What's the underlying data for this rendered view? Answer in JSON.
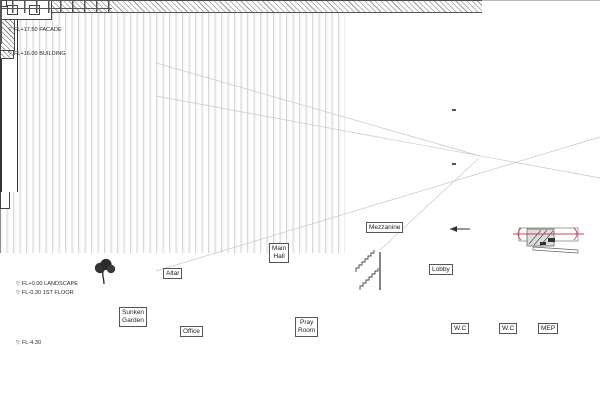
{
  "drawing": {
    "type": "architectural-section",
    "levels": [
      {
        "marker": "▽",
        "label": "FL+17.50 FACADE"
      },
      {
        "marker": "▽",
        "label": "FL+16.00 BUILDING"
      },
      {
        "marker": "▽",
        "label": "FL+0.00 LANDSCAPE"
      },
      {
        "marker": "▽",
        "label": "FL-0.30 1ST FLOOR"
      },
      {
        "marker": "▽",
        "label": "FL-4.30"
      }
    ],
    "rooms": {
      "altar": "Altar",
      "main_hall": [
        "Main",
        "Hall"
      ],
      "mezzanine": "Mezzanine",
      "lobby": "Lobby",
      "sunken_garden": [
        "Sunken",
        "Garden"
      ],
      "office": "Office",
      "pray_room": [
        "Pray",
        "Room"
      ],
      "wc_left": "W.C",
      "wc_right": "W.C",
      "mep": "MEP"
    },
    "colors": {
      "line": "#3a3a3a",
      "reference_line": "#b8b8b8",
      "facade_fin": "#d7d7d7",
      "detail_accent": "#cc4455"
    }
  }
}
